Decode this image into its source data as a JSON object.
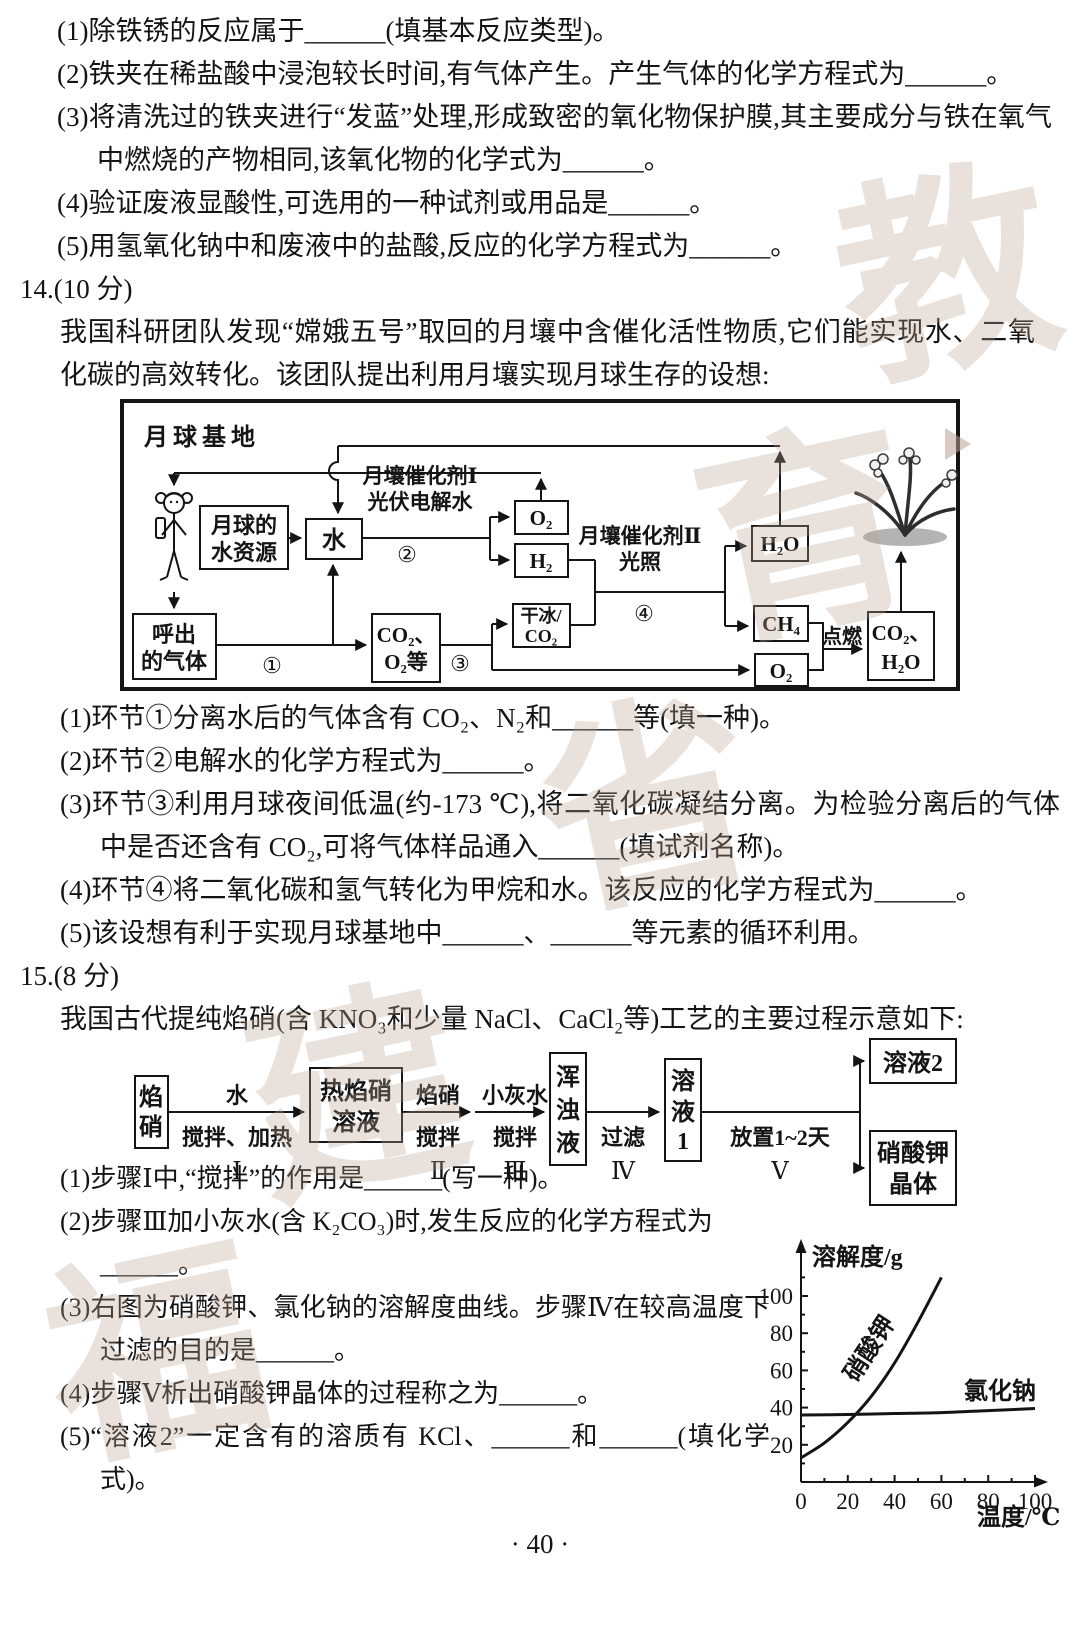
{
  "q13": {
    "items": [
      "(1)除铁锈的反应属于______(填基本反应类型)。",
      "(2)铁夹在稀盐酸中浸泡较长时间,有气体产生。产生气体的化学方程式为______。",
      "(3)将清洗过的铁夹进行“发蓝”处理,形成致密的氧化物保护膜,其主要成分与铁在氧气中燃烧的产物相同,该氧化物的化学式为______。",
      "(4)验证废液显酸性,可选用的一种试剂或用品是______。",
      "(5)用氢氧化钠中和废液中的盐酸,反应的化学方程式为______。"
    ]
  },
  "q14": {
    "heading": "14.(10 分)",
    "intro": "我国科研团队发现“嫦娥五号”取回的月壤中含催化活性物质,它们能实现水、二氧化碳的高效转化。该团队提出利用月壤实现月球生存的设想:",
    "diagram": {
      "title": "月球基地",
      "boxes": {
        "water_resource": [
          "月球的",
          "水资源"
        ],
        "water": "水",
        "o2_top": "O₂",
        "h2": "H₂",
        "dry_ice": [
          "干冰/",
          "CO₂"
        ],
        "h2o": "H₂O",
        "ch4": "CH₄",
        "o2_bottom": "O₂",
        "co2_h2o": [
          "CO₂、",
          "H₂O"
        ],
        "exhaled": [
          "呼出",
          "的气体"
        ],
        "co2_o2": [
          "CO₂、",
          "O₂等"
        ]
      },
      "labels": {
        "catalyst1": [
          "月壤催化剂Ⅰ",
          "光伏电解水"
        ],
        "catalyst2": [
          "月壤催化剂Ⅱ",
          "光照"
        ],
        "step1": "①",
        "step2": "②",
        "step3": "③",
        "step4": "④",
        "ignite": "点燃"
      }
    },
    "items": [
      "(1)环节①分离水后的气体含有 CO₂、N₂和______等(填一种)。",
      "(2)环节②电解水的化学方程式为______。",
      "(3)环节③利用月球夜间低温(约-173 ℃),将二氧化碳凝结分离。为检验分离后的气体中是否还含有 CO₂,可将气体样品通入______(填试剂名称)。",
      "(4)环节④将二氧化碳和氢气转化为甲烷和水。该反应的化学方程式为______。",
      "(5)该设想有利于实现月球基地中______、______等元素的循环利用。"
    ]
  },
  "q15": {
    "heading": "15.(8 分)",
    "intro": "我国古代提纯焰硝(含 KNO₃和少量 NaCl、CaCl₂等)工艺的主要过程示意如下:",
    "flow": {
      "boxes": {
        "start": [
          "焰",
          "硝"
        ],
        "hot": [
          "热焰硝",
          "溶液"
        ],
        "turbid": [
          "浑",
          "浊",
          "液"
        ],
        "sol1": [
          "溶",
          "液",
          "1"
        ],
        "sol2": "溶液2",
        "crystal": [
          "硝酸钾",
          "晶体"
        ]
      },
      "steps": [
        {
          "above": "水",
          "below": "搅拌、加热",
          "num": "Ⅰ"
        },
        {
          "above": "焰硝",
          "below": "搅拌",
          "num": "Ⅱ"
        },
        {
          "above": "小灰水",
          "below": "搅拌",
          "num": "Ⅲ"
        },
        {
          "above": "",
          "below": "过滤",
          "num": "Ⅳ"
        },
        {
          "above": "",
          "below": "放置1~2天",
          "num": "Ⅴ"
        }
      ]
    },
    "items": [
      "(1)步骤Ⅰ中,“搅拌”的作用是______(写一种)。",
      "(2)步骤Ⅲ加小灰水(含 K₂CO₃)时,发生反应的化学方程式为\n______。",
      "(3)右图为硝酸钾、氯化钠的溶解度曲线。步骤Ⅳ在较高温度下过滤的目的是______。",
      "(4)步骤Ⅴ析出硝酸钾晶体的过程称之为______。",
      "(5)“溶液2”一定含有的溶质有 KCl、______和______(填化学式)。"
    ]
  },
  "chart_data": {
    "type": "line",
    "title": "",
    "ylabel": "溶解度/g",
    "xlabel": "温度/℃",
    "xlim": [
      0,
      100
    ],
    "ylim": [
      0,
      120
    ],
    "xticks": [
      0,
      20,
      40,
      60,
      80,
      100
    ],
    "yticks": [
      20,
      40,
      60,
      80,
      100
    ],
    "grid": false,
    "legend_position": "inline-labels",
    "series": [
      {
        "name": "硝酸钾",
        "x": [
          0,
          10,
          20,
          30,
          40,
          50,
          60
        ],
        "y": [
          13,
          21,
          32,
          46,
          64,
          86,
          110
        ]
      },
      {
        "name": "氯化钠",
        "x": [
          0,
          20,
          40,
          60,
          80,
          100
        ],
        "y": [
          36,
          36.3,
          36.8,
          37.3,
          38.4,
          39.5
        ]
      }
    ]
  },
  "footer": {
    "page_number": "· 40 ·"
  },
  "decor": {
    "watermark": [
      "福",
      "建",
      "省",
      "教",
      "育"
    ]
  }
}
